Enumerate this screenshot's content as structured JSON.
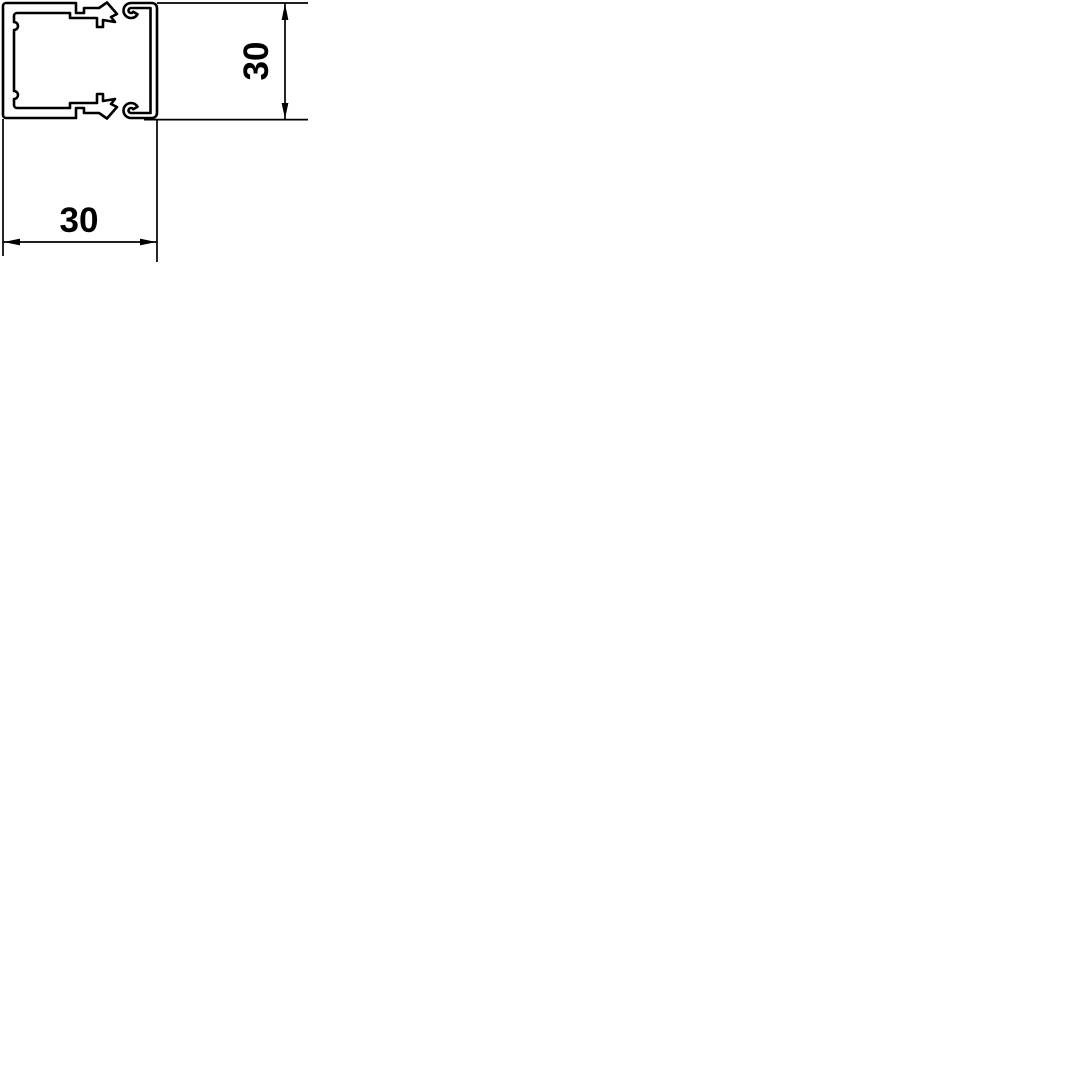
{
  "drawing": {
    "background_color": "#ffffff",
    "line_color": "#000000",
    "width_dimension": {
      "value": "30"
    },
    "height_dimension": {
      "value": "30"
    }
  }
}
